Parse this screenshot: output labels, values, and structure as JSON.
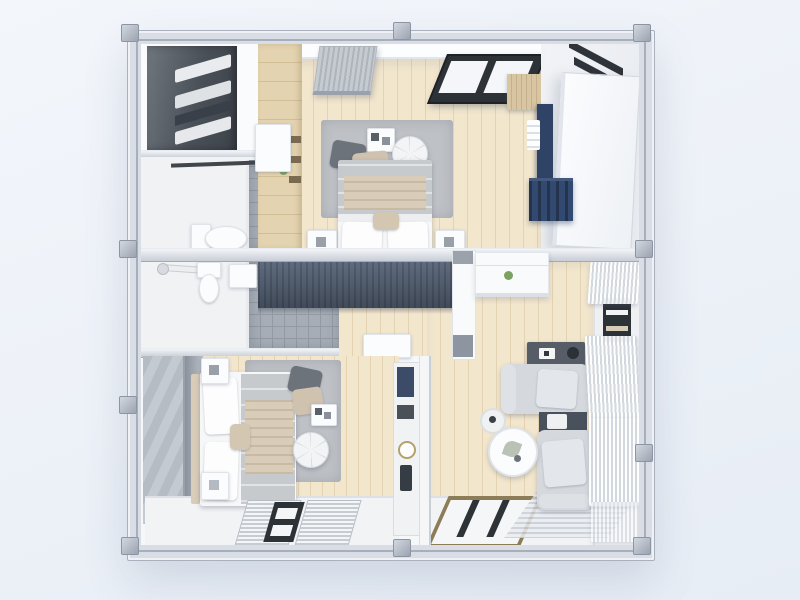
{
  "scene": {
    "type": "3d-floorplan-top-view",
    "description": "Top-down 3D render of a two-bedroom container home with steel frame",
    "rooms": [
      {
        "name": "wardrobe-nook",
        "furniture": [
          "dark wardrobe with open shelves",
          "folded towels"
        ]
      },
      {
        "name": "bathroom-upper",
        "furniture": [
          "toilet",
          "wall sink",
          "towel rail",
          "gray tiled floor"
        ]
      },
      {
        "name": "bathroom-lower",
        "furniture": [
          "toilet",
          "wall sink",
          "shower mixer",
          "gray tiled floor"
        ]
      },
      {
        "name": "bedroom-upper",
        "furniture": [
          "double bed with gray duvet",
          "area rug",
          "round pouf",
          "throw pillows",
          "magazine",
          "two nightstands",
          "air conditioner",
          "dark framed window",
          "wood shelving column",
          "wood cabinet",
          "navy media panel",
          "navy shelf"
        ]
      },
      {
        "name": "bedroom-lower",
        "furniture": [
          "double bed with gray duvet",
          "area rug",
          "round pouf",
          "magazine",
          "two nightstands",
          "dark slatted wardrobe",
          "white desk",
          "two blind windows",
          "divider shelf with clock and bottles"
        ]
      },
      {
        "name": "living-room",
        "furniture": [
          "l-shaped gray sofa",
          "dark side table",
          "dark console with remote",
          "round coffee table pair",
          "kitchen counter with plant",
          "curtained windows",
          "wood framed floor window",
          "striped floor mat"
        ]
      },
      {
        "name": "entry-corridor",
        "furniture": [
          "open white door panel",
          "dark transom window"
        ]
      }
    ],
    "structure": [
      "light steel frame with corner joints",
      "white exterior wall panels",
      "wood plank flooring",
      "white painted floor band"
    ]
  },
  "colors": {
    "bg1": "#f3f6fb",
    "bg2": "#e7edf5",
    "frame": "#d9dee6",
    "frameEdge": "#aab1bd",
    "innerLine": "#a8afba",
    "wall": "#f6f7f9",
    "white": "#fbfcfd",
    "whiteFloor": "#f2f3f5",
    "wood": "#f2e6cd",
    "woodLine": "#e3d3b2",
    "woodCab": "#e4d3b0",
    "woodCab2": "#d8c5a2",
    "tile": "#a6adb6",
    "tileLine": "#939aa4",
    "rug": "#bec1c5",
    "duvet": "#c7cacd",
    "beige": "#d9ccb8",
    "darkCabA": "#70767e",
    "darkCabB": "#3e444c",
    "slateCabA": "#5f6b7e",
    "slateCabB": "#414b5a",
    "navy": "#2e4366",
    "navyShelf": "#334a70",
    "sofa": "#d5d9de",
    "sofaLight": "#e3e6ea",
    "console": "#575d67",
    "sideTable": "#49515d",
    "curtainLine": "#d3d8df",
    "winDark": "#2d3237",
    "winWood": "#8d7c58",
    "green": "#7ca262",
    "grayPanel": "#b6bcc3"
  }
}
